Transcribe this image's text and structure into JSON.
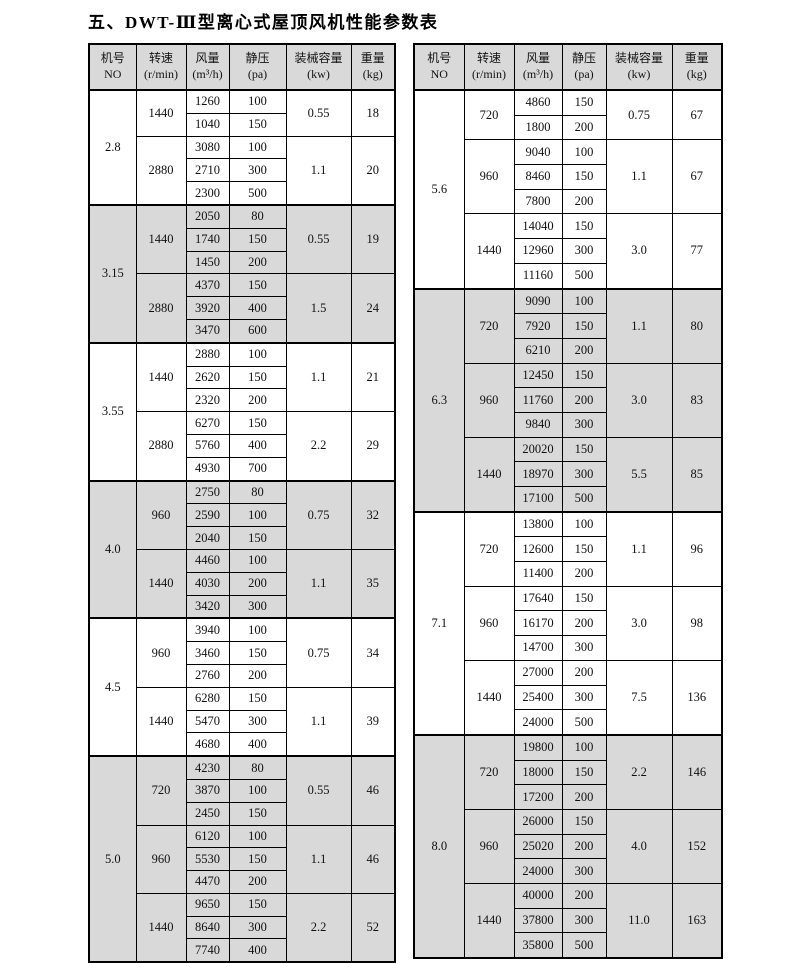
{
  "title": "五、DWT-Ⅲ型离心式屋顶风机性能参数表",
  "columns": [
    {
      "key": "no",
      "line1": "机号",
      "line2": "NO"
    },
    {
      "key": "speed",
      "line1": "转速",
      "line2": "(r/min)"
    },
    {
      "key": "airflow",
      "line1": "风量",
      "line2": "(m³/h)"
    },
    {
      "key": "pressure",
      "line1": "静压",
      "line2": "(pa)"
    },
    {
      "key": "power",
      "line1": "装械容量",
      "line2": "(kw)"
    },
    {
      "key": "weight",
      "line1": "重量",
      "line2": "(kg)"
    }
  ],
  "tables": [
    {
      "side": "left",
      "sections": [
        {
          "no": "2.8",
          "shaded": false,
          "groups": [
            {
              "speed": "1440",
              "power": "0.55",
              "weight": "18",
              "rows": [
                [
                  "1260",
                  "100"
                ],
                [
                  "1040",
                  "150"
                ]
              ]
            },
            {
              "speed": "2880",
              "power": "1.1",
              "weight": "20",
              "rows": [
                [
                  "3080",
                  "100"
                ],
                [
                  "2710",
                  "300"
                ],
                [
                  "2300",
                  "500"
                ]
              ]
            }
          ]
        },
        {
          "no": "3.15",
          "shaded": true,
          "groups": [
            {
              "speed": "1440",
              "power": "0.55",
              "weight": "19",
              "rows": [
                [
                  "2050",
                  "80"
                ],
                [
                  "1740",
                  "150"
                ],
                [
                  "1450",
                  "200"
                ]
              ]
            },
            {
              "speed": "2880",
              "power": "1.5",
              "weight": "24",
              "rows": [
                [
                  "4370",
                  "150"
                ],
                [
                  "3920",
                  "400"
                ],
                [
                  "3470",
                  "600"
                ]
              ]
            }
          ]
        },
        {
          "no": "3.55",
          "shaded": false,
          "groups": [
            {
              "speed": "1440",
              "power": "1.1",
              "weight": "21",
              "rows": [
                [
                  "2880",
                  "100"
                ],
                [
                  "2620",
                  "150"
                ],
                [
                  "2320",
                  "200"
                ]
              ]
            },
            {
              "speed": "2880",
              "power": "2.2",
              "weight": "29",
              "rows": [
                [
                  "6270",
                  "150"
                ],
                [
                  "5760",
                  "400"
                ],
                [
                  "4930",
                  "700"
                ]
              ]
            }
          ]
        },
        {
          "no": "4.0",
          "shaded": true,
          "groups": [
            {
              "speed": "960",
              "power": "0.75",
              "weight": "32",
              "rows": [
                [
                  "2750",
                  "80"
                ],
                [
                  "2590",
                  "100"
                ],
                [
                  "2040",
                  "150"
                ]
              ]
            },
            {
              "speed": "1440",
              "power": "1.1",
              "weight": "35",
              "rows": [
                [
                  "4460",
                  "100"
                ],
                [
                  "4030",
                  "200"
                ],
                [
                  "3420",
                  "300"
                ]
              ]
            }
          ]
        },
        {
          "no": "4.5",
          "shaded": false,
          "groups": [
            {
              "speed": "960",
              "power": "0.75",
              "weight": "34",
              "rows": [
                [
                  "3940",
                  "100"
                ],
                [
                  "3460",
                  "150"
                ],
                [
                  "2760",
                  "200"
                ]
              ]
            },
            {
              "speed": "1440",
              "power": "1.1",
              "weight": "39",
              "rows": [
                [
                  "6280",
                  "150"
                ],
                [
                  "5470",
                  "300"
                ],
                [
                  "4680",
                  "400"
                ]
              ]
            }
          ]
        },
        {
          "no": "5.0",
          "shaded": true,
          "groups": [
            {
              "speed": "720",
              "power": "0.55",
              "weight": "46",
              "rows": [
                [
                  "4230",
                  "80"
                ],
                [
                  "3870",
                  "100"
                ],
                [
                  "2450",
                  "150"
                ]
              ]
            },
            {
              "speed": "960",
              "power": "1.1",
              "weight": "46",
              "rows": [
                [
                  "6120",
                  "100"
                ],
                [
                  "5530",
                  "150"
                ],
                [
                  "4470",
                  "200"
                ]
              ]
            },
            {
              "speed": "1440",
              "power": "2.2",
              "weight": "52",
              "rows": [
                [
                  "9650",
                  "150"
                ],
                [
                  "8640",
                  "300"
                ],
                [
                  "7740",
                  "400"
                ]
              ]
            }
          ]
        }
      ]
    },
    {
      "side": "right",
      "sections": [
        {
          "no": "5.6",
          "shaded": false,
          "groups": [
            {
              "speed": "720",
              "power": "0.75",
              "weight": "67",
              "rows": [
                [
                  "4860",
                  "150"
                ],
                [
                  "1800",
                  "200"
                ]
              ]
            },
            {
              "speed": "960",
              "power": "1.1",
              "weight": "67",
              "rows": [
                [
                  "9040",
                  "100"
                ],
                [
                  "8460",
                  "150"
                ],
                [
                  "7800",
                  "200"
                ]
              ]
            },
            {
              "speed": "1440",
              "power": "3.0",
              "weight": "77",
              "rows": [
                [
                  "14040",
                  "150"
                ],
                [
                  "12960",
                  "300"
                ],
                [
                  "11160",
                  "500"
                ]
              ]
            }
          ]
        },
        {
          "no": "6.3",
          "shaded": true,
          "groups": [
            {
              "speed": "720",
              "power": "1.1",
              "weight": "80",
              "rows": [
                [
                  "9090",
                  "100"
                ],
                [
                  "7920",
                  "150"
                ],
                [
                  "6210",
                  "200"
                ]
              ]
            },
            {
              "speed": "960",
              "power": "3.0",
              "weight": "83",
              "rows": [
                [
                  "12450",
                  "150"
                ],
                [
                  "11760",
                  "200"
                ],
                [
                  "9840",
                  "300"
                ]
              ]
            },
            {
              "speed": "1440",
              "power": "5.5",
              "weight": "85",
              "rows": [
                [
                  "20020",
                  "150"
                ],
                [
                  "18970",
                  "300"
                ],
                [
                  "17100",
                  "500"
                ]
              ]
            }
          ]
        },
        {
          "no": "7.1",
          "shaded": false,
          "groups": [
            {
              "speed": "720",
              "power": "1.1",
              "weight": "96",
              "rows": [
                [
                  "13800",
                  "100"
                ],
                [
                  "12600",
                  "150"
                ],
                [
                  "11400",
                  "200"
                ]
              ]
            },
            {
              "speed": "960",
              "power": "3.0",
              "weight": "98",
              "rows": [
                [
                  "17640",
                  "150"
                ],
                [
                  "16170",
                  "200"
                ],
                [
                  "14700",
                  "300"
                ]
              ]
            },
            {
              "speed": "1440",
              "power": "7.5",
              "weight": "136",
              "rows": [
                [
                  "27000",
                  "200"
                ],
                [
                  "25400",
                  "300"
                ],
                [
                  "24000",
                  "500"
                ]
              ]
            }
          ]
        },
        {
          "no": "8.0",
          "shaded": true,
          "groups": [
            {
              "speed": "720",
              "power": "2.2",
              "weight": "146",
              "rows": [
                [
                  "19800",
                  "100"
                ],
                [
                  "18000",
                  "150"
                ],
                [
                  "17200",
                  "200"
                ]
              ]
            },
            {
              "speed": "960",
              "power": "4.0",
              "weight": "152",
              "rows": [
                [
                  "26000",
                  "150"
                ],
                [
                  "25020",
                  "200"
                ],
                [
                  "24000",
                  "300"
                ]
              ]
            },
            {
              "speed": "1440",
              "power": "11.0",
              "weight": "163",
              "rows": [
                [
                  "40000",
                  "200"
                ],
                [
                  "37800",
                  "300"
                ],
                [
                  "35800",
                  "500"
                ]
              ]
            }
          ]
        }
      ]
    }
  ]
}
